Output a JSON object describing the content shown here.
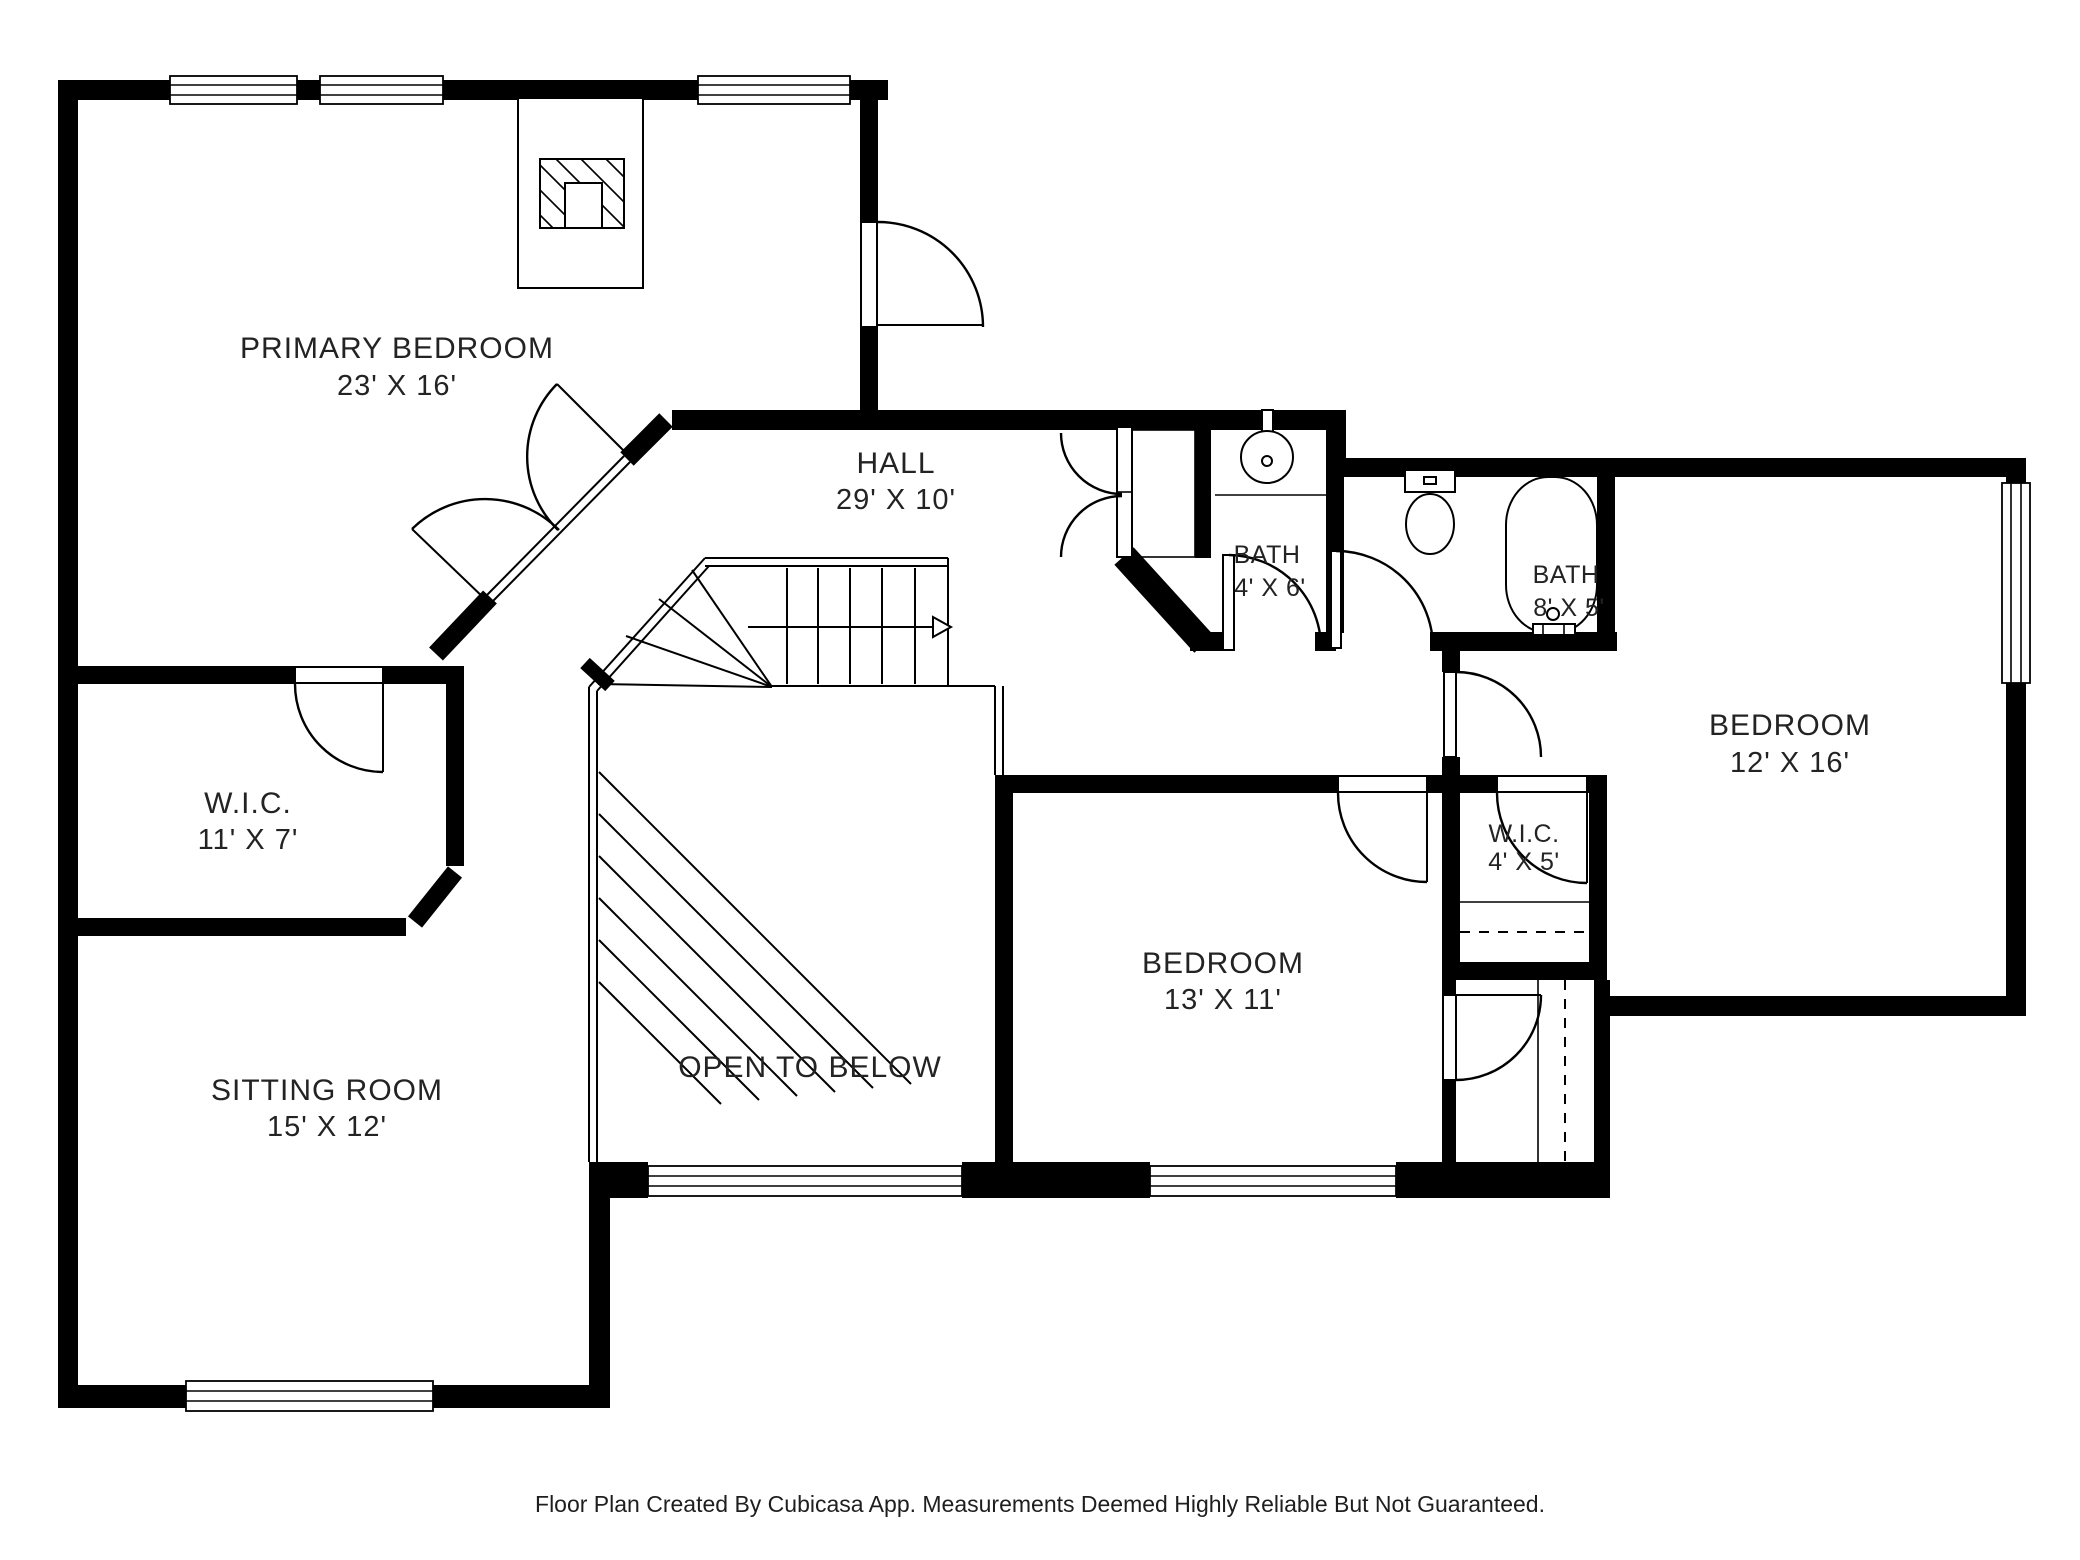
{
  "plan": {
    "footer": "Floor Plan Created By Cubicasa App. Measurements Deemed Highly Reliable But Not Guaranteed.",
    "colors": {
      "wall": "#000000",
      "label": "#232323",
      "background": "#ffffff"
    },
    "rooms": [
      {
        "name": "PRIMARY BEDROOM",
        "dims": "23' X 16'"
      },
      {
        "name": "HALL",
        "dims": "29' X 10'"
      },
      {
        "name": "BATH",
        "dims": "4' X 6'"
      },
      {
        "name": "BATH",
        "dims": "8' X 5'"
      },
      {
        "name": "BEDROOM",
        "dims": "12' X 16'"
      },
      {
        "name": "W.I.C.",
        "dims": "4' X 5'"
      },
      {
        "name": "BEDROOM",
        "dims": "13' X 11'"
      },
      {
        "name": "W.I.C.",
        "dims": "11' X 7'"
      },
      {
        "name": "OPEN TO BELOW",
        "dims": ""
      },
      {
        "name": "SITTING ROOM",
        "dims": "15' X 12'"
      }
    ]
  }
}
